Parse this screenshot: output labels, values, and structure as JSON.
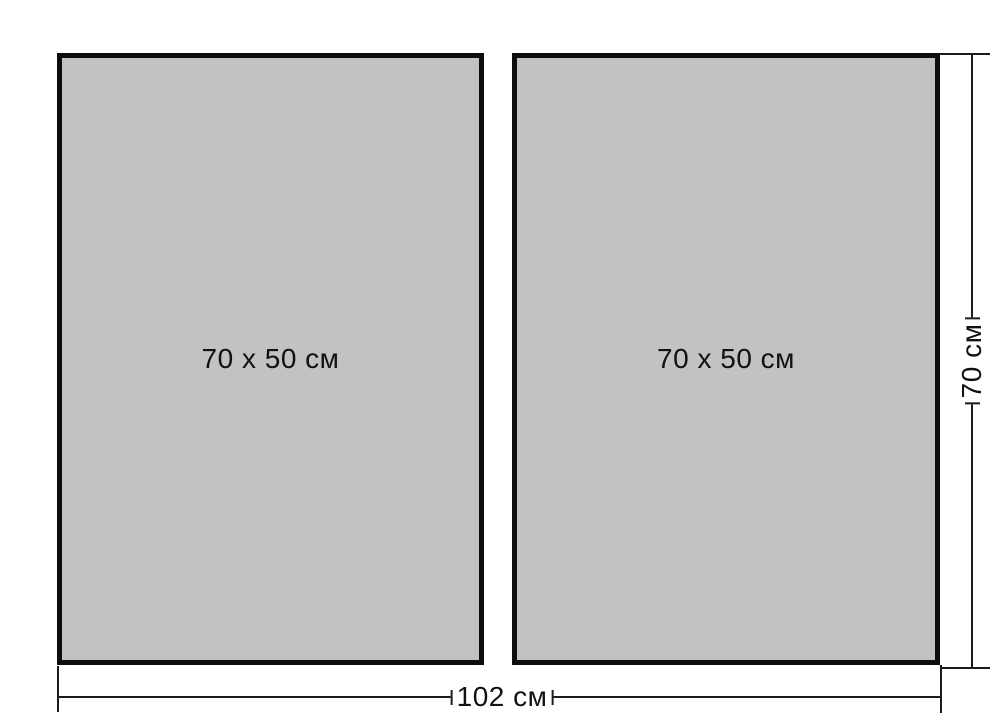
{
  "diagram": {
    "panels": [
      {
        "label": "70 x 50 см"
      },
      {
        "label": "70 x 50 см"
      }
    ],
    "width_dimension": {
      "label": "102 см"
    },
    "height_dimension": {
      "label": "70 см"
    },
    "colors": {
      "background": "#ffffff",
      "panel_fill": "#c2c2c2",
      "panel_border": "#0d0d0d",
      "dimension_line": "#1c1c1c",
      "text": "#111111"
    }
  }
}
